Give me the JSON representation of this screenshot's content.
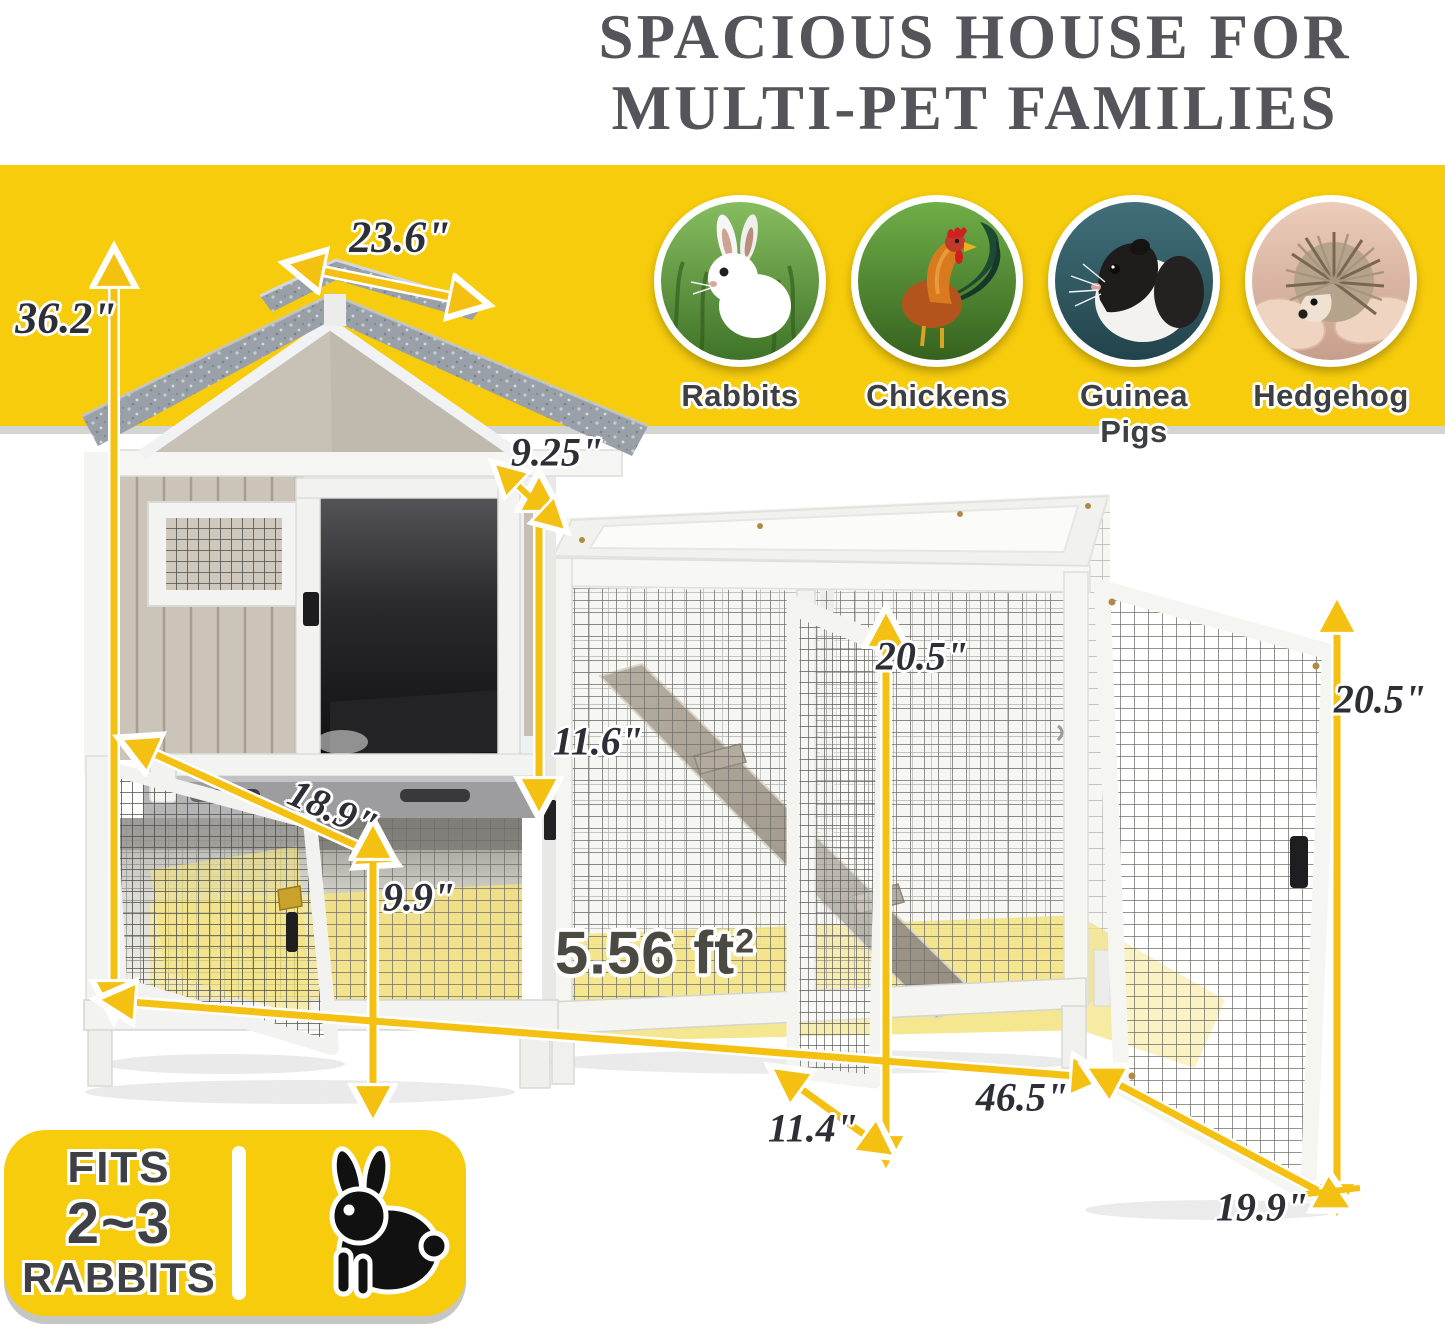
{
  "title": {
    "line1": "SPACIOUS HOUSE FOR",
    "line2": "MULTI-PET FAMILIES"
  },
  "banner": {
    "pets": [
      {
        "label": "Rabbits",
        "icon": "rabbit-photo"
      },
      {
        "label": "Chickens",
        "icon": "rooster-photo"
      },
      {
        "label": "Guinea Pigs",
        "icon": "guinea-pig-photo"
      },
      {
        "label": "Hedgehog",
        "icon": "hedgehog-photo"
      }
    ]
  },
  "dimensions": {
    "roof_depth": "23.6\"",
    "total_height": "36.2\"",
    "roof_overhang": "9.25\"",
    "house_door_height": "11.6\"",
    "run_door_height": "20.5\"",
    "end_door_height": "20.5\"",
    "lower_door_width": "18.9\"",
    "lower_level_height": "9.9\"",
    "middle_door_width": "11.4\"",
    "run_length": "46.5\"",
    "end_door_width": "19.9\""
  },
  "area": {
    "value": "5.56 ft",
    "sup": "2"
  },
  "badge": {
    "line1": "FITS",
    "line2": "2~3",
    "line3": "RABBITS"
  },
  "colors": {
    "banner_yellow": "#F7CC0C",
    "arrow_yellow": "#F4C113",
    "floor_highlight": "#F3E27C",
    "dimension_text": "#2E2F36",
    "title_text": "#54545A",
    "roof_gray": "#9AA0A7",
    "wall_beige": "#CBC4B8"
  }
}
